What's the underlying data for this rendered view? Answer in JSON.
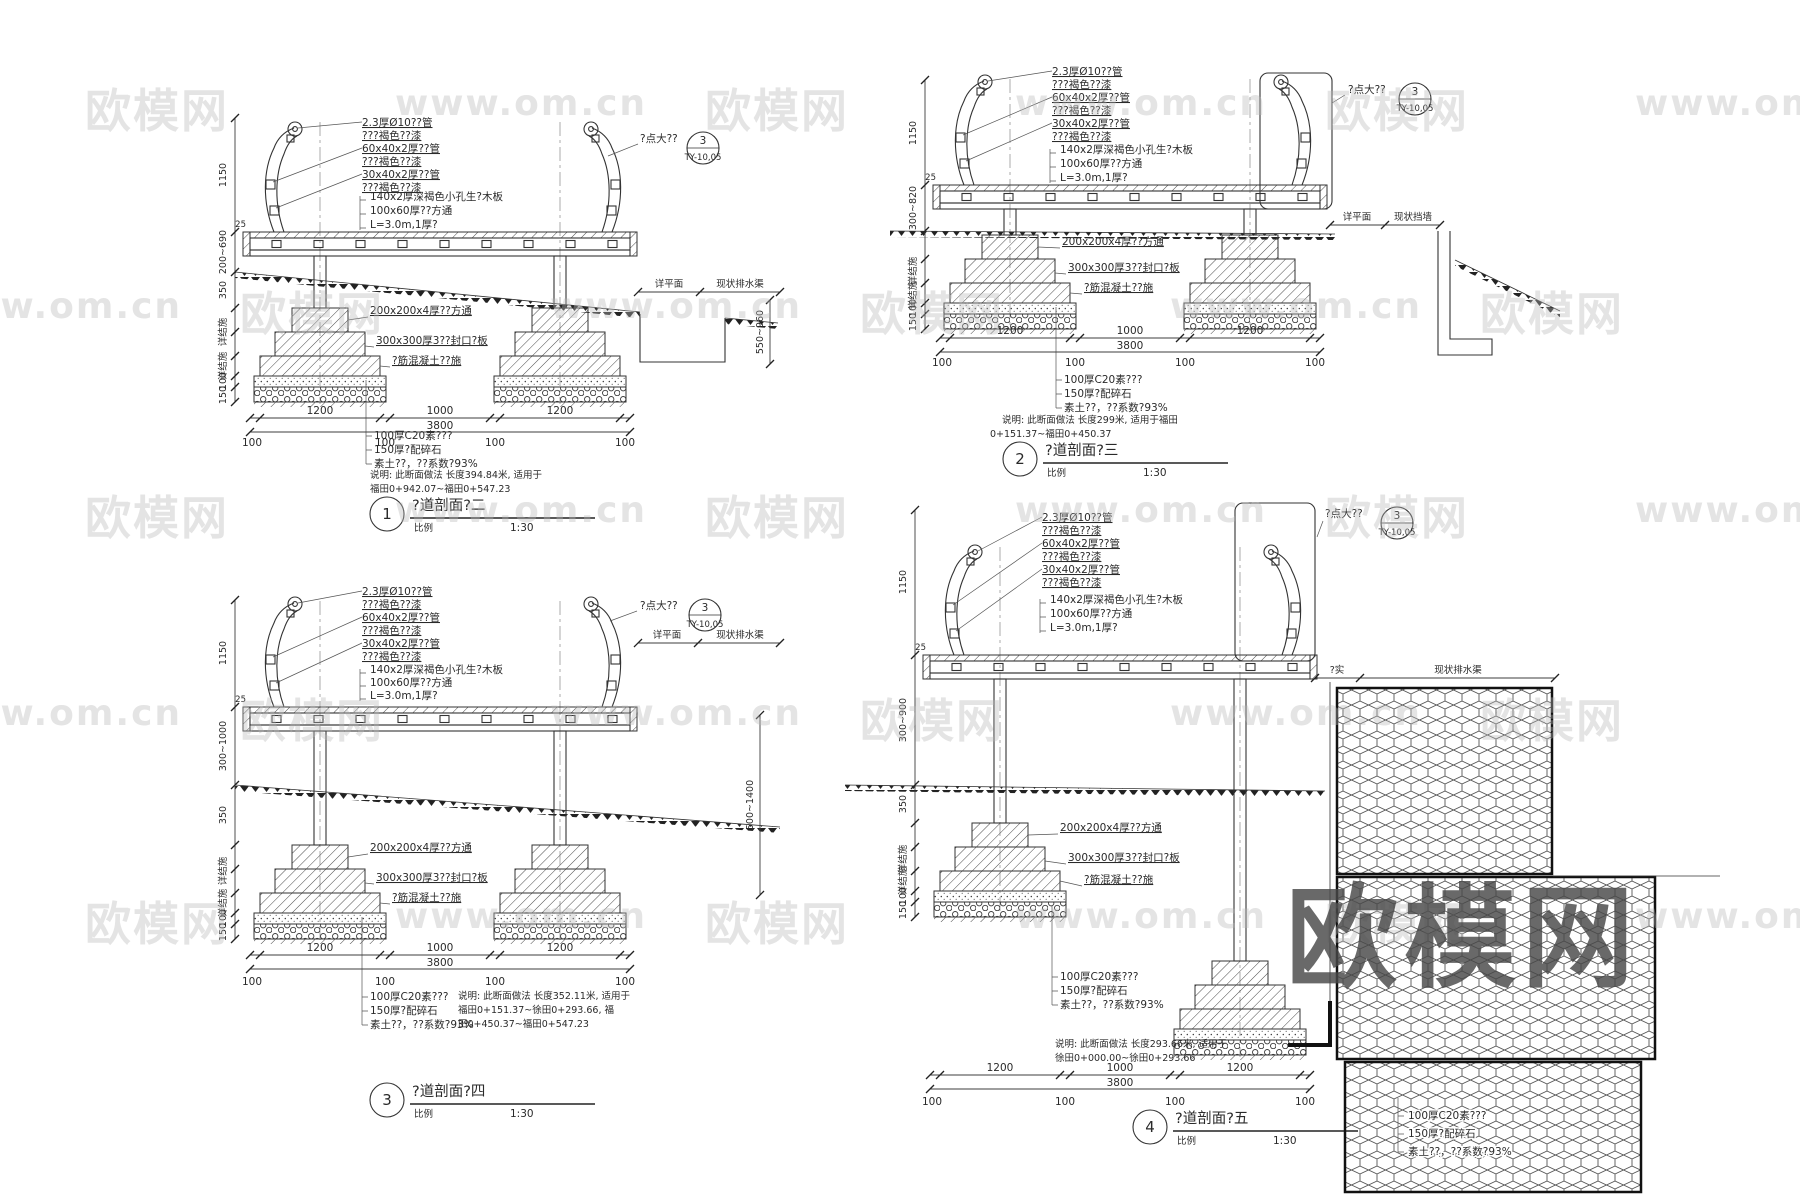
{
  "common": {
    "rail_labels": [
      "2.3厚Ø10??管",
      "???褐色??漆",
      "60x40x2厚??管",
      "???褐色??漆",
      "30x40x2厚??管",
      "???褐色??漆"
    ],
    "deck_labels": [
      "140x2厚深褐色小孔生?木板",
      "100x60厚??方通",
      "L=3.0m,1厚?"
    ],
    "footing_labels": [
      "200x200x4厚??方通",
      "300x300厚3??封口?板",
      "?筋混凝土??施"
    ],
    "base_labels": [
      "100厚C20素???",
      "150厚?配碎石",
      "素土??，??系数?93%"
    ],
    "dim_1150": "1150",
    "dim_350": "350",
    "dim_100": "100",
    "dim_150": "150",
    "dim_25": "25",
    "struct_ref": "详结施",
    "seg_a": "1200",
    "seg_b": "1000",
    "seg_c": "1200",
    "total": "3800",
    "edge": "100",
    "scale_label": "比例",
    "scale_value": "1:30",
    "callout_text": "?点大??",
    "callout_num": "3",
    "callout_ref": "TY-10,05",
    "plan": "详平面",
    "drain": "现状排水渠",
    "wall": "现状挡墙",
    "compact": "?实"
  },
  "details": [
    {
      "num": "1",
      "title": "?道剖面?二",
      "span": "200~690",
      "right_v": "550~960",
      "notes": [
        "说明: 此断面做法 长度394.84米, 适用于",
        "福田0+942.07~福田0+547.23"
      ]
    },
    {
      "num": "2",
      "title": "?道剖面?三",
      "span": "300~820",
      "notes": [
        "说明: 此断面做法 长度299米, 适用于福田",
        "0+151.37~福田0+450.37"
      ]
    },
    {
      "num": "3",
      "title": "?道剖面?四",
      "span": "300~1000",
      "right_v": "500~1400",
      "notes": [
        "说明: 此断面做法 长度352.11米, 适用于",
        "福田0+151.37~徐田0+293.66, 福",
        "田0+450.37~福田0+547.23"
      ]
    },
    {
      "num": "4",
      "title": "?道剖面?五",
      "span": "300~900",
      "notes": [
        "说明: 此断面做法 长度293.66米, 适用于",
        "徐田0+000.00~徐田0+293.66"
      ]
    }
  ],
  "watermark": {
    "brand": "欧模网",
    "site": "www.om.cn"
  }
}
